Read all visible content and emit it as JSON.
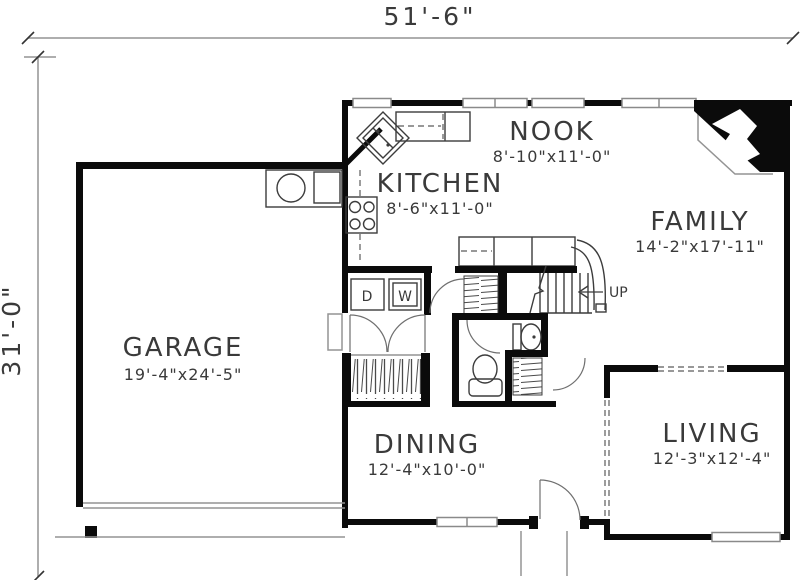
{
  "plan": {
    "overall_width": "51'-6\"",
    "overall_depth": "31'-0\"",
    "rooms": [
      {
        "name": "NOOK",
        "dims": "8'-10\"x11'-0\""
      },
      {
        "name": "KITCHEN",
        "dims": "8'-6\"x11'-0\""
      },
      {
        "name": "FAMILY",
        "dims": "14'-2\"x17'-11\""
      },
      {
        "name": "GARAGE",
        "dims": "19'-4\"x24'-5\""
      },
      {
        "name": "DINING",
        "dims": "12'-4\"x10'-0\""
      },
      {
        "name": "LIVING",
        "dims": "12'-3\"x12'-4\""
      }
    ],
    "annotations": {
      "stairs_direction": "UP",
      "dryer": "D",
      "washer": "W"
    },
    "colors": {
      "walls": "#0b0b0b",
      "lines": "#3c3c3c",
      "light_lines": "#949494",
      "background": "#ffffff"
    }
  }
}
